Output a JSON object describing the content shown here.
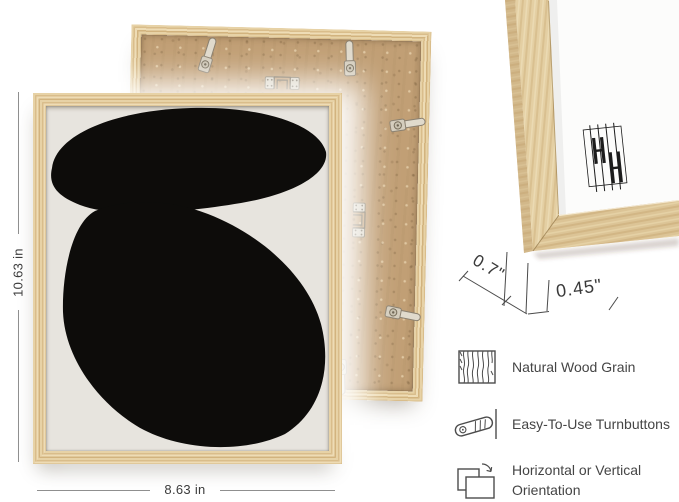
{
  "page": {
    "background": "#ffffff"
  },
  "dimensions": {
    "height_label": "10.63 in",
    "width_label": "8.63 in",
    "depth_label": "0.7\"",
    "face_width_label": "0.45\""
  },
  "features": {
    "items": [
      {
        "icon": "wood-grain-icon",
        "label": "Natural Wood Grain"
      },
      {
        "icon": "turnbutton-icon",
        "label": "Easy-To-Use Turnbuttons"
      },
      {
        "icon": "orientation-icon",
        "label": "Horizontal or Vertical Orientation"
      }
    ]
  },
  "artwork": {
    "style": "abstract black organic shapes on warm gray paper",
    "background": "#e7e4de",
    "shape_color": "#0d0c0a"
  },
  "hardware": {
    "turnbutton_count": 5,
    "sawtooth_hanger_count": 2
  },
  "colors": {
    "wood": "#ddc394",
    "wood_dark": "#c9ab77",
    "mdf_board": "#c19f75",
    "metal": "#d9d3c6",
    "dimension_line": "#8f8f8f",
    "annotation_text": "#3b3b3b",
    "feature_text": "#454545"
  }
}
